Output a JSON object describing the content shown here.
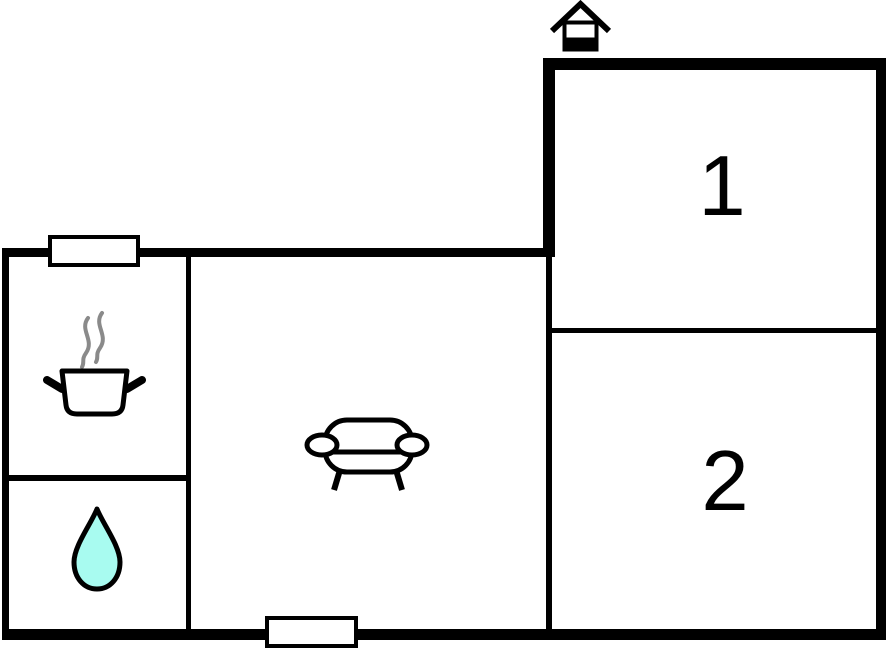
{
  "floorplan": {
    "rooms": [
      {
        "id": "room-1",
        "label": "1"
      },
      {
        "id": "room-2",
        "label": "2"
      }
    ],
    "icons": [
      {
        "name": "entrance-house-icon"
      },
      {
        "name": "cooking-pot-icon"
      },
      {
        "name": "steam-icon"
      },
      {
        "name": "water-drop-icon"
      },
      {
        "name": "sofa-icon"
      },
      {
        "name": "window-marker-top"
      },
      {
        "name": "window-marker-bottom"
      }
    ],
    "colors": {
      "background": "#ffffff",
      "wall": "#000000",
      "steam": "#8a8a8a",
      "water_drop": "#a8fbf0",
      "window_fill": "#ffffff",
      "room_label": "#000000"
    }
  }
}
